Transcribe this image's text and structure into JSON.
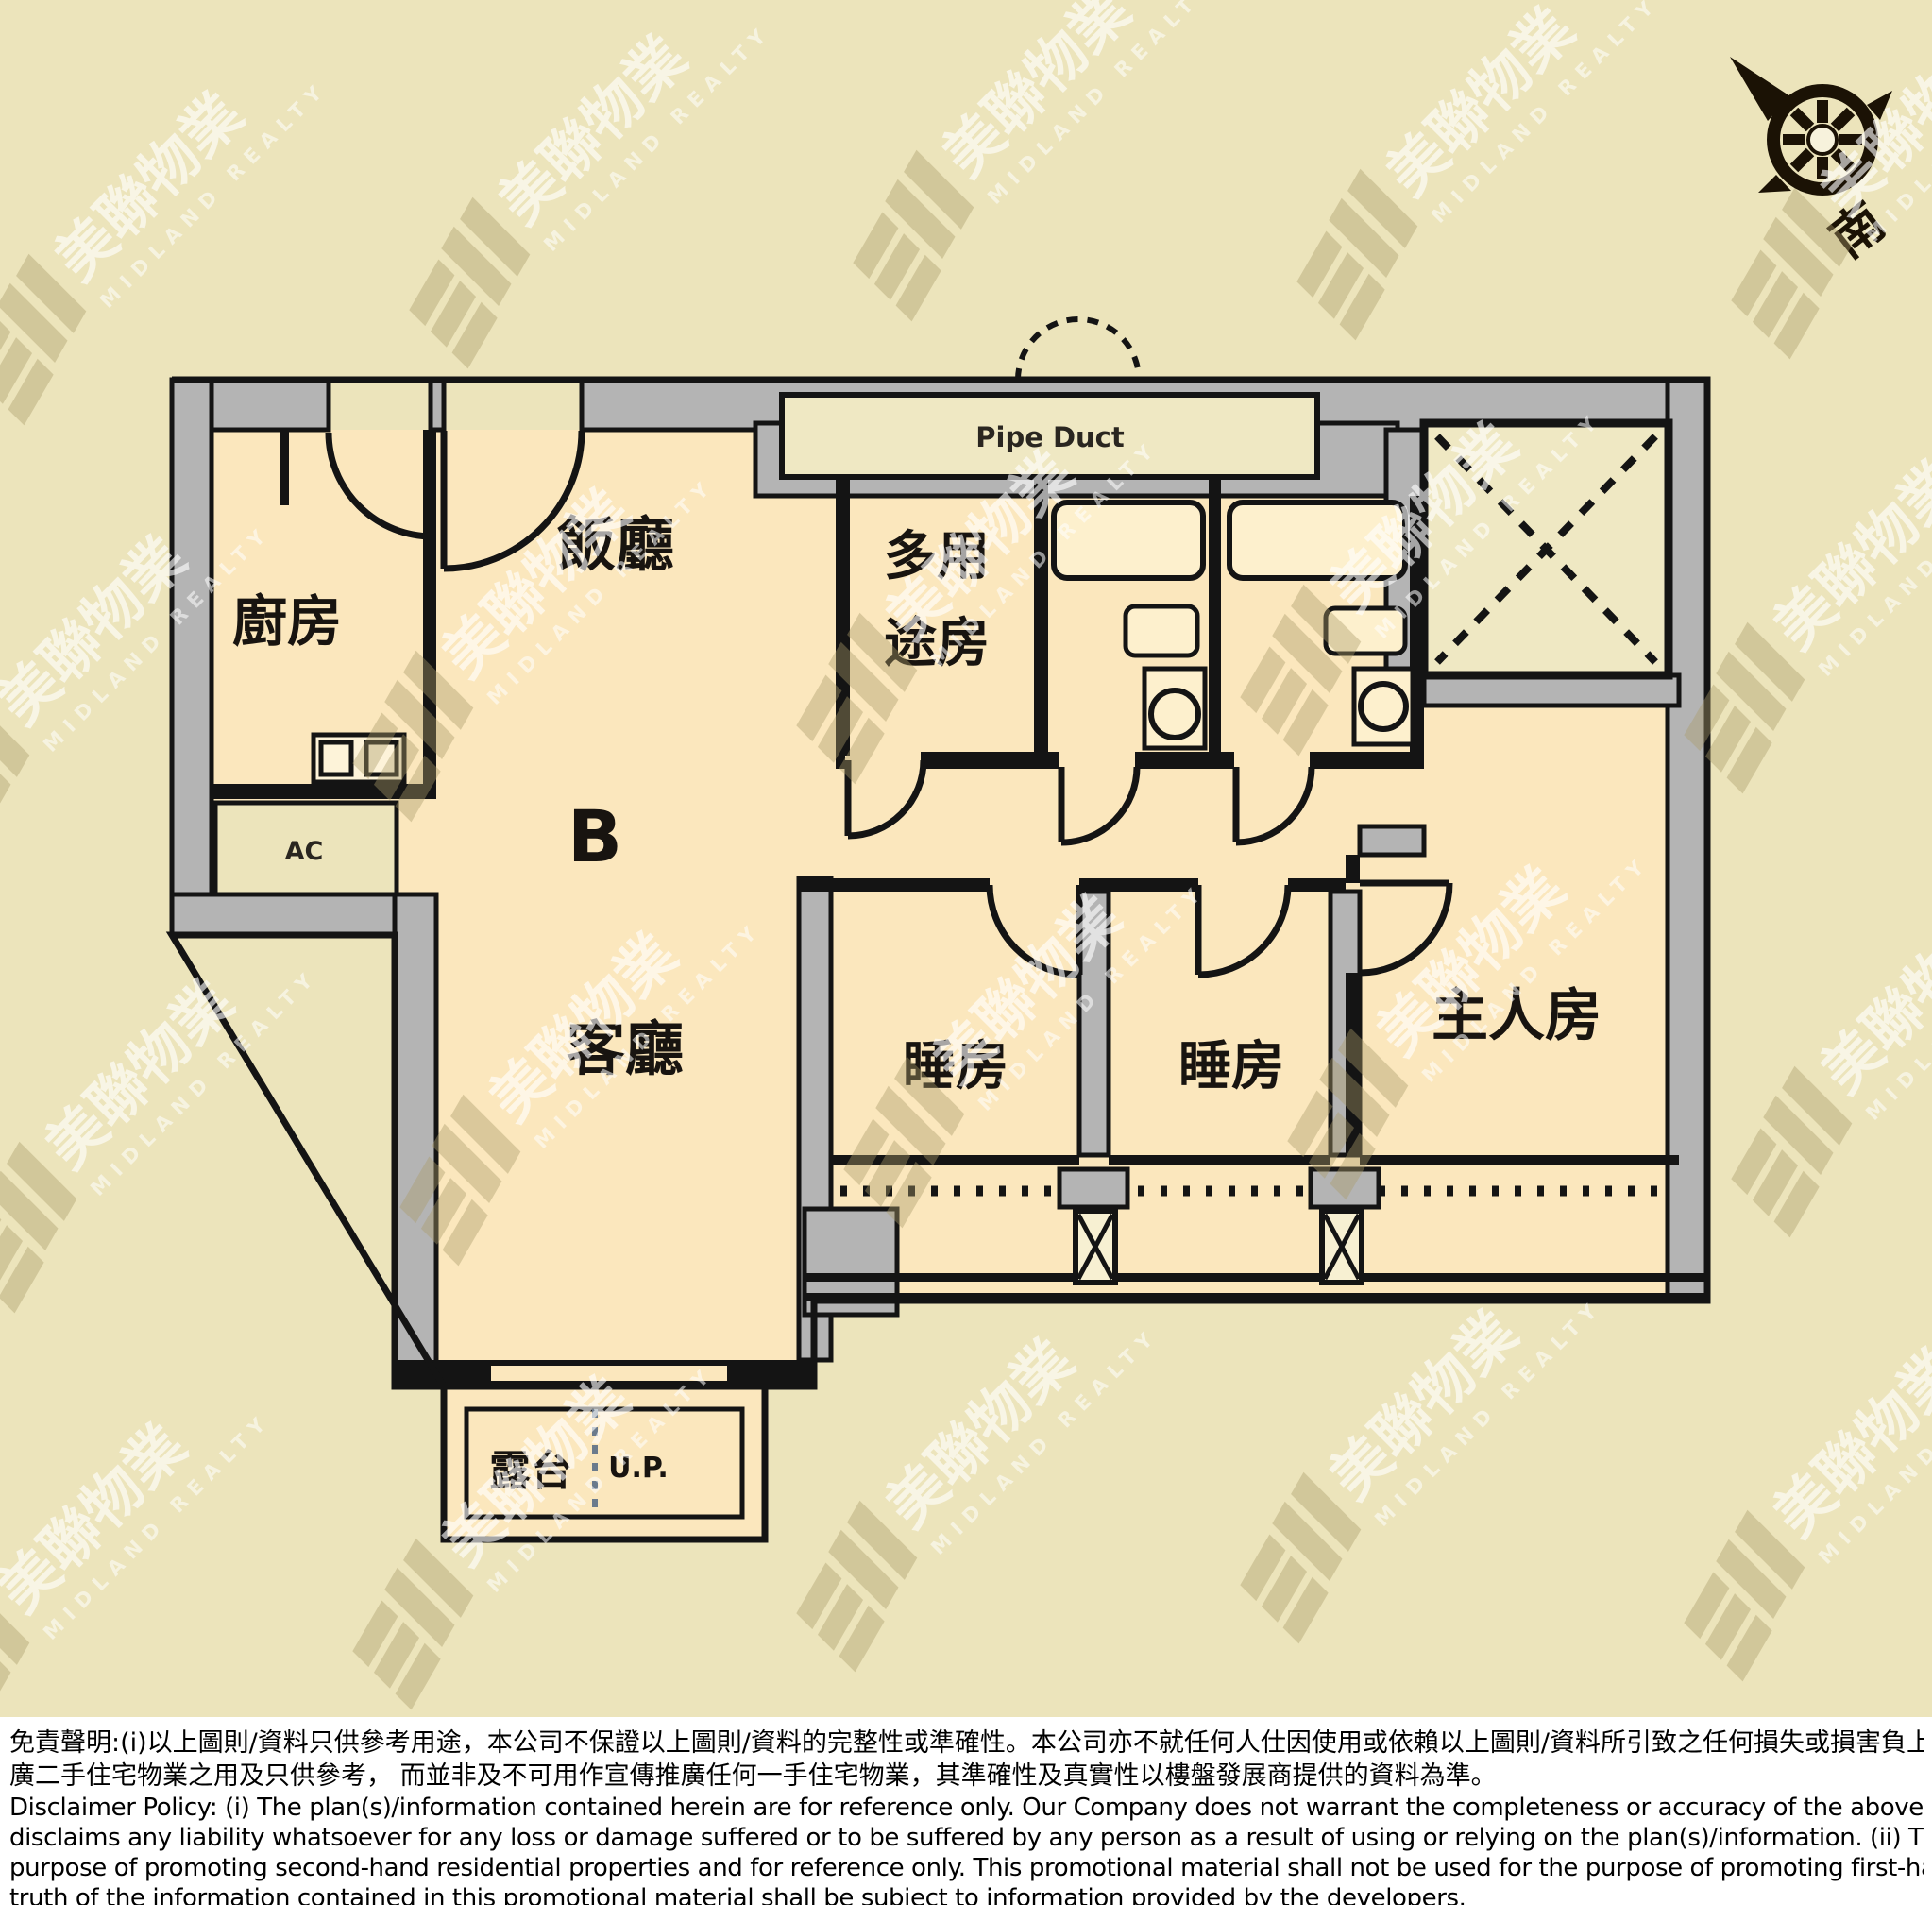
{
  "floor_plan": {
    "unit_label": "B",
    "labels": {
      "kitchen": "廚房",
      "dining_room": "飯廳",
      "living_room": "客廳",
      "multipurpose_line1": "多用",
      "multipurpose_line2": "途房",
      "bedroom_left": "睡房",
      "bedroom_right": "睡房",
      "master_bedroom": "主人房",
      "balcony": "露台",
      "utility_platform": "U.P.",
      "ac_platform": "AC",
      "pipe_duct": "Pipe Duct"
    },
    "compass": {
      "south_label": "南"
    },
    "colors": {
      "page_background": "#ece4bb",
      "room_fill": "#fbe7bd",
      "duct_lift_fill": "#efe8c3",
      "wall_gray": "#b4b4b4",
      "line_black": "#141414",
      "compass_dark": "#1b1205"
    }
  },
  "watermark": {
    "name_cjk": "美聯物業",
    "name_latin": "MIDLAND REALTY"
  },
  "disclaimer": {
    "zh_line1": "免責聲明:(i)以上圖則/資料只供參考用途，本公司不保證以上圖則/資料的完整性或準確性。本公司亦不就任何人仕因使用或依賴以上圖則/資料所引致之任何損失或損害負上任何責任。(ii)本宣傳資料只可作宣傳及推",
    "zh_line2": "廣二手住宅物業之用及只供參考， 而並非及不可用作宣傳推廣任何一手住宅物業，其準確性及真實性以樓盤發展商提供的資料為準。",
    "en_line1": "Disclaimer Policy: (i) The plan(s)/information contained herein are for reference only. Our Company does not warrant the completeness or accuracy of the above plan(s)/information. Our Company also",
    "en_line2": "disclaims any liability whatsoever for any loss or damage suffered or to be suffered by any person as a result of using or relying on the plan(s)/information. (ii) This promotional material is for the",
    "en_line3": "purpose of promoting second-hand residential properties and for reference only. This promotional material shall not be used for the purpose of promoting first-hand residential properties. The accuracy and",
    "en_line4": "truth of the information contained in this promotional material shall be subject to information provided by the developers."
  }
}
